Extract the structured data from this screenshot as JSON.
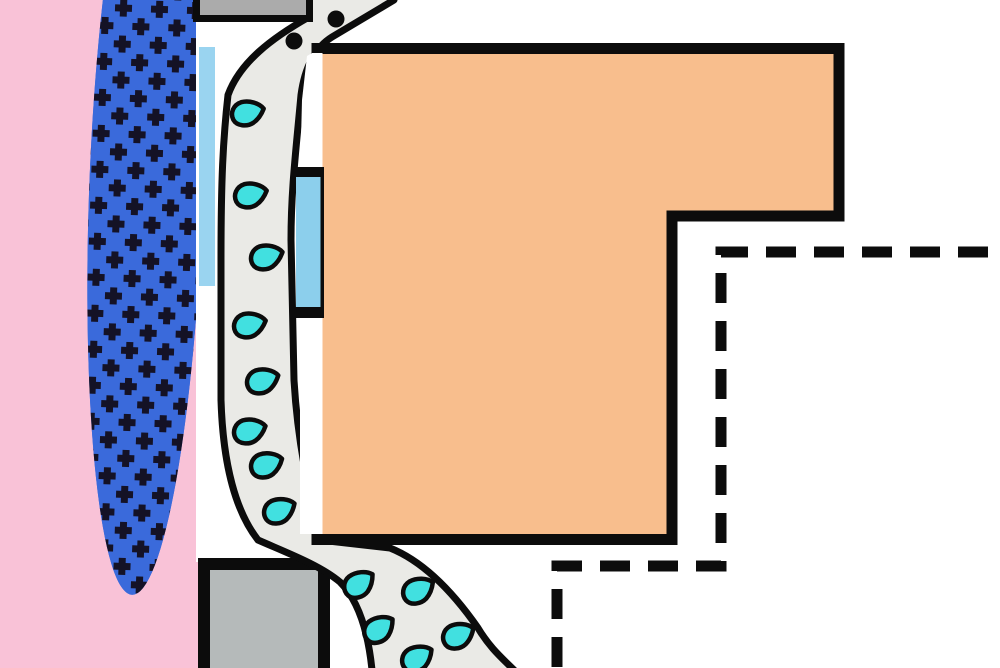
{
  "colors": {
    "background_white": "#ffffff",
    "skin_pink": "#f9c2d7",
    "gland_blue": "#3a6adb",
    "gland_plus_dark": "#141226",
    "duct_gray": "#eaeae6",
    "device_orange": "#f8be8d",
    "cap_gray": "#ababab",
    "block_gray": "#b5baba",
    "bar_blue_left": "#9ad4f0",
    "bar_blue_right": "#8ccfec",
    "droplet_cyan": "#41e0e0",
    "outline_black": "#0c0c0c"
  },
  "diagram": {
    "duct_droplets": [
      {
        "x": 245,
        "y": 114,
        "rot": -4
      },
      {
        "x": 248,
        "y": 196,
        "rot": -4
      },
      {
        "x": 264,
        "y": 258,
        "rot": -6
      },
      {
        "x": 247,
        "y": 326,
        "rot": -4
      },
      {
        "x": 260,
        "y": 382,
        "rot": -8
      },
      {
        "x": 247,
        "y": 432,
        "rot": -6
      },
      {
        "x": 264,
        "y": 466,
        "rot": -10
      },
      {
        "x": 277,
        "y": 512,
        "rot": -14
      }
    ],
    "outlet_droplets": [
      {
        "x": 357,
        "y": 586,
        "rot": -25
      },
      {
        "x": 416,
        "y": 592,
        "rot": -18
      },
      {
        "x": 377,
        "y": 631,
        "rot": -25
      },
      {
        "x": 456,
        "y": 637,
        "rot": -15
      },
      {
        "x": 415,
        "y": 660,
        "rot": -20
      }
    ],
    "pore_dots": [
      {
        "x": 294,
        "y": 41,
        "r": 8.5
      },
      {
        "x": 336,
        "y": 19,
        "r": 8.5
      }
    ]
  }
}
